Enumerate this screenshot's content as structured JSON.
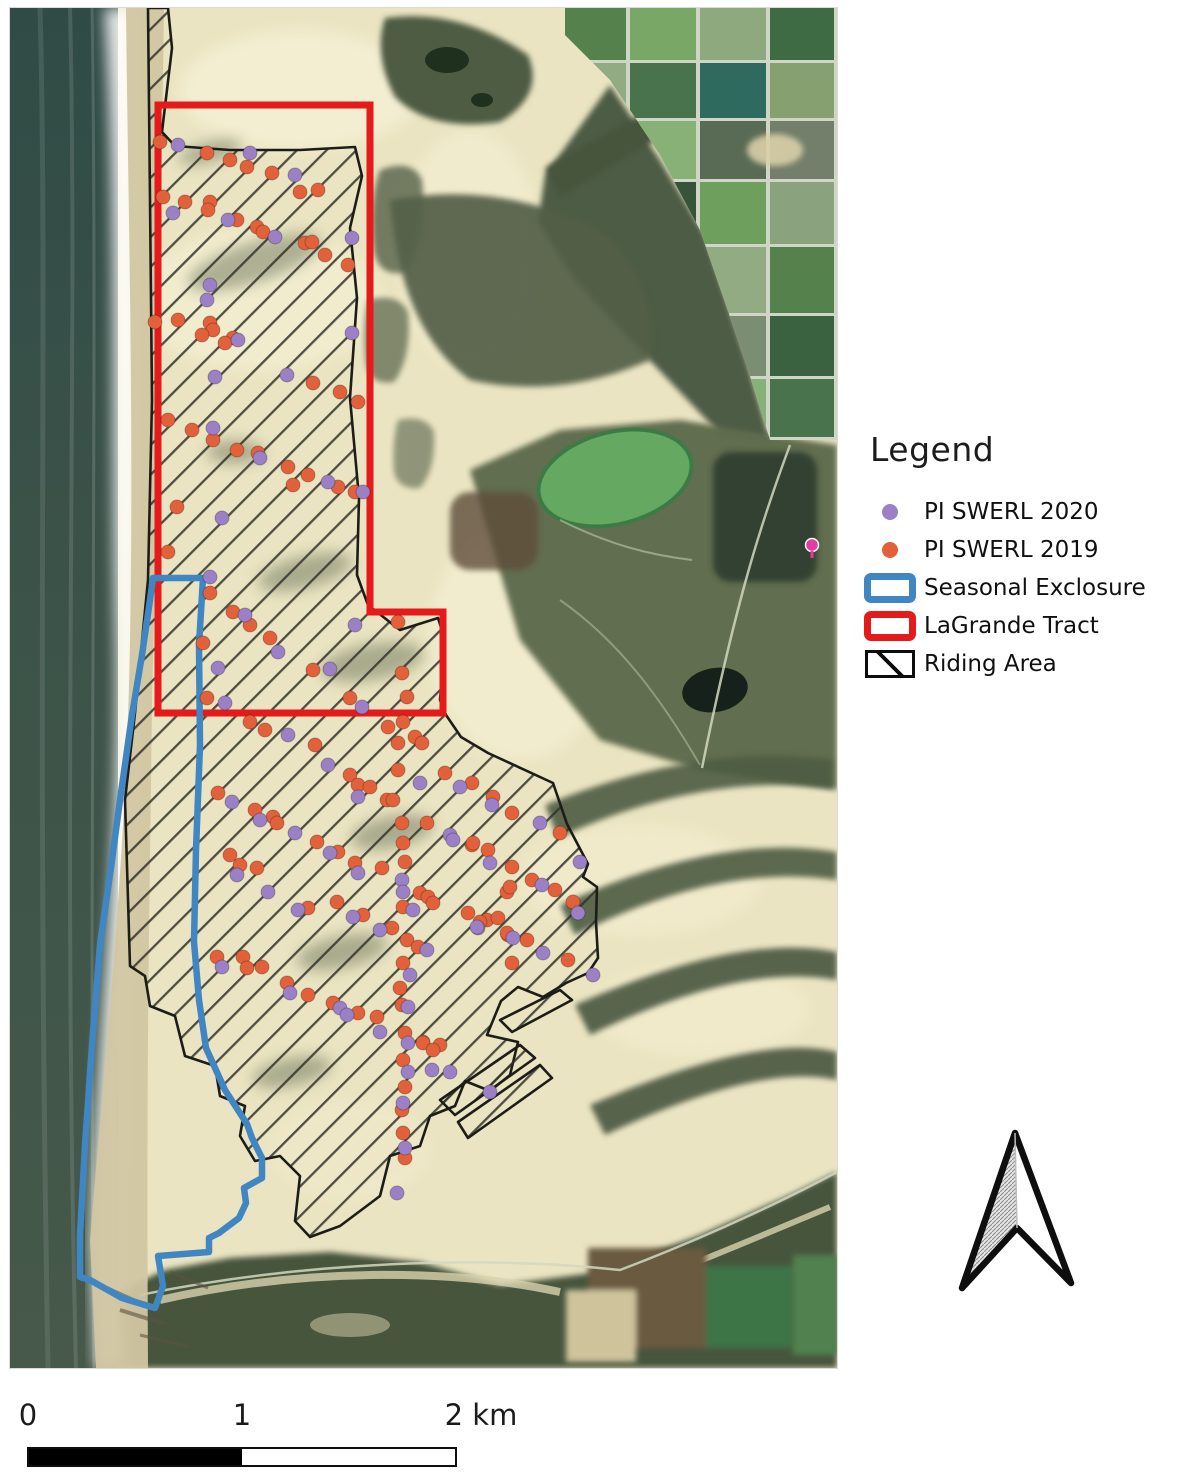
{
  "legend": {
    "title": "Legend",
    "items": [
      {
        "label": "PI SWERL 2020",
        "swatch": "dot-purple"
      },
      {
        "label": "PI SWERL 2019",
        "swatch": "dot-orange"
      },
      {
        "label": "Seasonal Exclosure",
        "swatch": "blue-outline-box"
      },
      {
        "label": "LaGrande Tract",
        "swatch": "red-outline-box"
      },
      {
        "label": "Riding Area",
        "swatch": "black-hatched-box"
      }
    ]
  },
  "scale_bar": {
    "labels": [
      {
        "text": "0"
      },
      {
        "text": "1"
      },
      {
        "text": "2 km"
      }
    ]
  },
  "north_arrow": {
    "name": "north-arrow",
    "points_direction": "up"
  },
  "colors": {
    "swerl_2020": "#9b80c6",
    "swerl_2019": "#e2613a",
    "seasonal_exclosure": "#3f86c2",
    "lagrande_tract": "#e51a1a",
    "riding_area_outline": "#1d1d18",
    "ocean": "#3a5046",
    "sand": "#eae4c2",
    "vegetation": "#4e5c44"
  },
  "map": {
    "overlays": [
      "Riding Area hatched polygon",
      "LaGrande Tract red rectangle with bottom-right notch",
      "Seasonal Exclosure blue strip along beach"
    ],
    "dot_radius": 7,
    "dots_2019": [
      [
        160,
        142
      ],
      [
        207,
        153
      ],
      [
        230,
        160
      ],
      [
        247,
        167
      ],
      [
        272,
        173
      ],
      [
        300,
        192
      ],
      [
        318,
        190
      ],
      [
        163,
        197
      ],
      [
        185,
        202
      ],
      [
        210,
        202
      ],
      [
        208,
        210
      ],
      [
        237,
        220
      ],
      [
        257,
        227
      ],
      [
        263,
        232
      ],
      [
        305,
        243
      ],
      [
        312,
        242
      ],
      [
        325,
        255
      ],
      [
        348,
        265
      ],
      [
        155,
        322
      ],
      [
        178,
        320
      ],
      [
        210,
        323
      ],
      [
        213,
        330
      ],
      [
        202,
        335
      ],
      [
        233,
        338
      ],
      [
        225,
        343
      ],
      [
        313,
        383
      ],
      [
        340,
        392
      ],
      [
        358,
        402
      ],
      [
        168,
        420
      ],
      [
        192,
        430
      ],
      [
        213,
        440
      ],
      [
        237,
        450
      ],
      [
        258,
        453
      ],
      [
        288,
        467
      ],
      [
        308,
        475
      ],
      [
        293,
        485
      ],
      [
        338,
        487
      ],
      [
        355,
        492
      ],
      [
        177,
        507
      ],
      [
        168,
        552
      ],
      [
        210,
        593
      ],
      [
        233,
        612
      ],
      [
        250,
        625
      ],
      [
        270,
        638
      ],
      [
        203,
        643
      ],
      [
        313,
        670
      ],
      [
        398,
        622
      ],
      [
        402,
        673
      ],
      [
        407,
        697
      ],
      [
        350,
        698
      ],
      [
        207,
        698
      ],
      [
        250,
        722
      ],
      [
        265,
        730
      ],
      [
        315,
        745
      ],
      [
        388,
        727
      ],
      [
        403,
        722
      ],
      [
        398,
        743
      ],
      [
        415,
        737
      ],
      [
        422,
        743
      ],
      [
        350,
        775
      ],
      [
        358,
        785
      ],
      [
        370,
        787
      ],
      [
        398,
        770
      ],
      [
        445,
        773
      ],
      [
        387,
        800
      ],
      [
        393,
        800
      ],
      [
        218,
        793
      ],
      [
        255,
        810
      ],
      [
        273,
        817
      ],
      [
        230,
        855
      ],
      [
        240,
        865
      ],
      [
        257,
        868
      ],
      [
        277,
        823
      ],
      [
        317,
        842
      ],
      [
        338,
        852
      ],
      [
        355,
        863
      ],
      [
        382,
        868
      ],
      [
        402,
        823
      ],
      [
        427,
        823
      ],
      [
        403,
        843
      ],
      [
        405,
        862
      ],
      [
        420,
        893
      ],
      [
        428,
        897
      ],
      [
        472,
        845
      ],
      [
        488,
        850
      ],
      [
        507,
        892
      ],
      [
        337,
        902
      ],
      [
        308,
        908
      ],
      [
        363,
        915
      ],
      [
        392,
        928
      ],
      [
        403,
        907
      ],
      [
        433,
        903
      ],
      [
        468,
        913
      ],
      [
        487,
        920
      ],
      [
        498,
        918
      ],
      [
        508,
        935
      ],
      [
        407,
        940
      ],
      [
        418,
        947
      ],
      [
        403,
        963
      ],
      [
        217,
        957
      ],
      [
        243,
        957
      ],
      [
        247,
        968
      ],
      [
        262,
        967
      ],
      [
        287,
        983
      ],
      [
        308,
        995
      ],
      [
        333,
        1003
      ],
      [
        358,
        1013
      ],
      [
        377,
        1017
      ],
      [
        402,
        1005
      ],
      [
        400,
        988
      ],
      [
        405,
        1033
      ],
      [
        423,
        1042
      ],
      [
        440,
        1045
      ],
      [
        472,
        783
      ],
      [
        493,
        797
      ],
      [
        512,
        813
      ],
      [
        560,
        833
      ],
      [
        473,
        843
      ],
      [
        512,
        867
      ],
      [
        532,
        880
      ],
      [
        555,
        890
      ],
      [
        510,
        887
      ],
      [
        573,
        902
      ],
      [
        480,
        922
      ],
      [
        507,
        933
      ],
      [
        527,
        940
      ],
      [
        568,
        960
      ],
      [
        512,
        963
      ],
      [
        423,
        1043
      ],
      [
        433,
        1050
      ],
      [
        403,
        1060
      ],
      [
        405,
        1087
      ],
      [
        402,
        1110
      ],
      [
        403,
        1133
      ],
      [
        405,
        1158
      ]
    ],
    "dots_2020": [
      [
        178,
        145
      ],
      [
        250,
        153
      ],
      [
        295,
        175
      ],
      [
        173,
        213
      ],
      [
        228,
        220
      ],
      [
        275,
        237
      ],
      [
        352,
        238
      ],
      [
        210,
        285
      ],
      [
        207,
        300
      ],
      [
        238,
        340
      ],
      [
        352,
        333
      ],
      [
        215,
        377
      ],
      [
        287,
        375
      ],
      [
        213,
        428
      ],
      [
        260,
        458
      ],
      [
        328,
        482
      ],
      [
        363,
        492
      ],
      [
        222,
        518
      ],
      [
        210,
        577
      ],
      [
        245,
        615
      ],
      [
        278,
        652
      ],
      [
        218,
        668
      ],
      [
        330,
        669
      ],
      [
        355,
        625
      ],
      [
        362,
        707
      ],
      [
        225,
        703
      ],
      [
        288,
        735
      ],
      [
        328,
        765
      ],
      [
        420,
        783
      ],
      [
        358,
        797
      ],
      [
        232,
        802
      ],
      [
        237,
        875
      ],
      [
        268,
        892
      ],
      [
        260,
        820
      ],
      [
        295,
        833
      ],
      [
        330,
        853
      ],
      [
        358,
        873
      ],
      [
        402,
        880
      ],
      [
        403,
        892
      ],
      [
        450,
        835
      ],
      [
        490,
        863
      ],
      [
        298,
        910
      ],
      [
        353,
        917
      ],
      [
        380,
        930
      ],
      [
        413,
        910
      ],
      [
        478,
        928
      ],
      [
        427,
        950
      ],
      [
        410,
        975
      ],
      [
        222,
        967
      ],
      [
        290,
        993
      ],
      [
        340,
        1008
      ],
      [
        347,
        1015
      ],
      [
        380,
        1032
      ],
      [
        408,
        1007
      ],
      [
        460,
        787
      ],
      [
        492,
        805
      ],
      [
        540,
        823
      ],
      [
        453,
        840
      ],
      [
        580,
        862
      ],
      [
        542,
        885
      ],
      [
        578,
        913
      ],
      [
        477,
        927
      ],
      [
        513,
        938
      ],
      [
        543,
        953
      ],
      [
        593,
        975
      ],
      [
        408,
        1043
      ],
      [
        408,
        1072
      ],
      [
        432,
        1070
      ],
      [
        450,
        1072
      ],
      [
        403,
        1103
      ],
      [
        405,
        1148
      ],
      [
        397,
        1193
      ],
      [
        490,
        1092
      ]
    ]
  }
}
